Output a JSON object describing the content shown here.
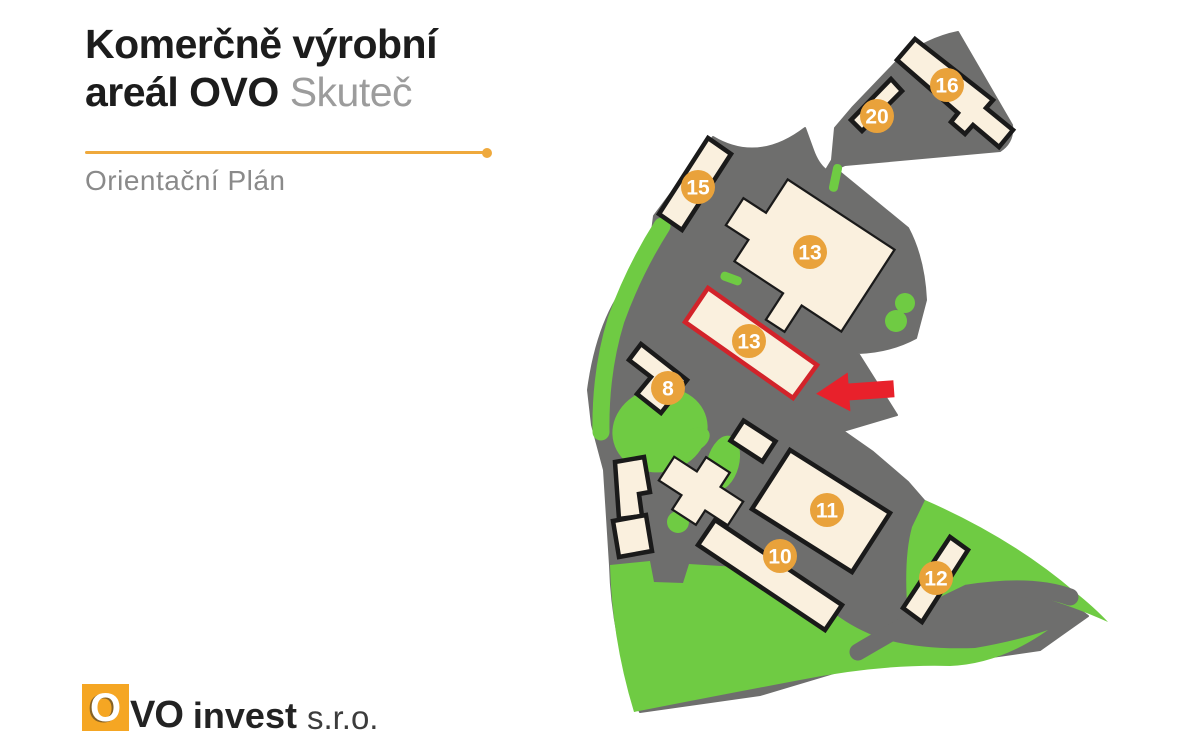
{
  "header": {
    "title_line1": "Komerčně výrobní",
    "title_line2_bold": "areál OVO",
    "title_line2_light": "Skuteč",
    "subtitle": "Orientační Plán",
    "accent_color": "#EFA93C",
    "ink_color": "#1C1C1C",
    "subtle_color": "#9C9C9C",
    "subtle2_color": "#8A8A8A"
  },
  "logo": {
    "square_letter": "O",
    "rest_letters": "VO",
    "word": "invest",
    "suffix": "s.r.o.",
    "orange": "#F5A623"
  },
  "map": {
    "colors": {
      "ground": "#6E6E6D",
      "grass": "#6FCB43",
      "building_fill": "#FAF0DE",
      "building_stroke": "#1A1A1A",
      "highlight": "#D2232A",
      "arrow": "#E8212B",
      "marker": "#E9A23B",
      "marker_text": "#FFFFFF"
    },
    "highlighted_building": "13",
    "markers": [
      {
        "label": "8",
        "x": 668,
        "y": 388
      },
      {
        "label": "10",
        "x": 780,
        "y": 556
      },
      {
        "label": "11",
        "x": 827,
        "y": 510
      },
      {
        "label": "12",
        "x": 936,
        "y": 578
      },
      {
        "label": "13",
        "x": 810,
        "y": 252
      },
      {
        "label": "13",
        "x": 749,
        "y": 341
      },
      {
        "label": "15",
        "x": 698,
        "y": 187
      },
      {
        "label": "16",
        "x": 947,
        "y": 85
      },
      {
        "label": "20",
        "x": 877,
        "y": 116
      }
    ]
  }
}
